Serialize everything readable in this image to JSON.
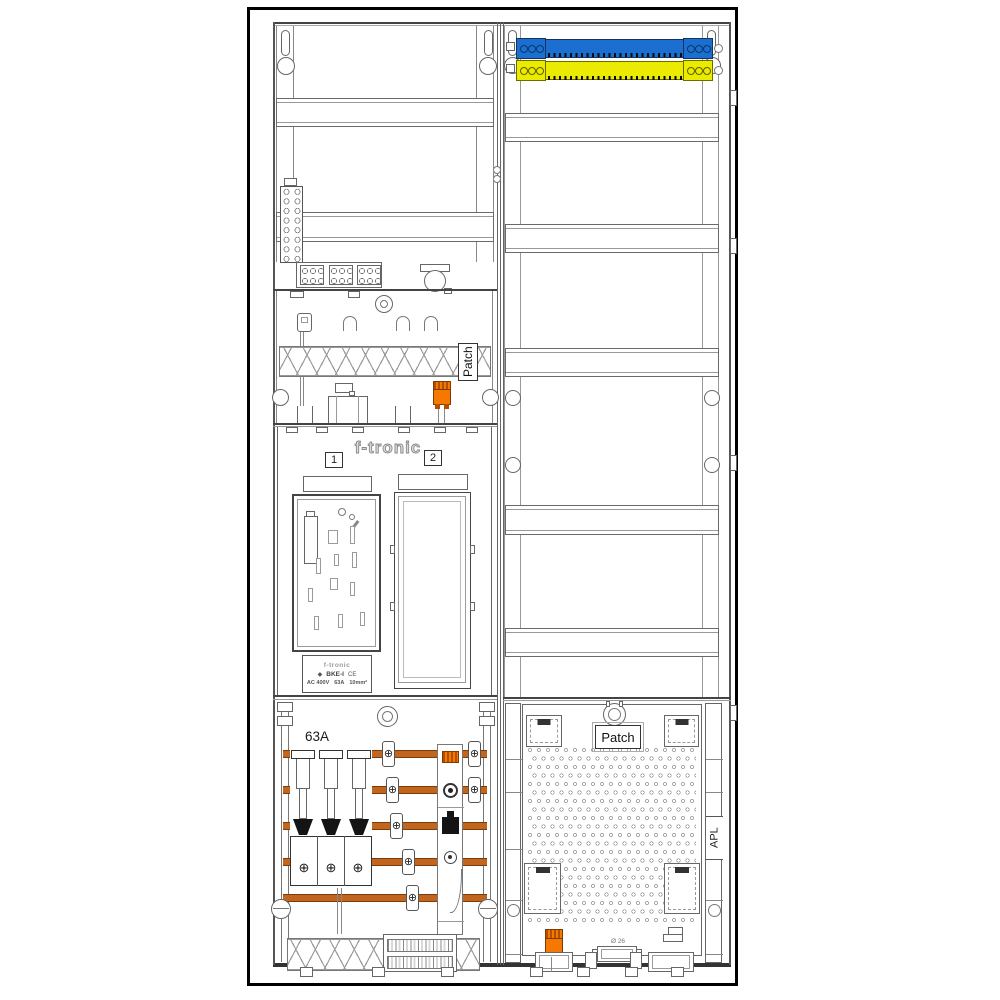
{
  "colors": {
    "page_frame": "#000000",
    "line": "#555555",
    "busbar_orange": "#c2661f",
    "connector_orange": "#f57900",
    "neutral_rail_blue": "#1b6fd0",
    "pe_rail_yellow": "#ebeb00",
    "black_part": "#141414"
  },
  "icons": {
    "clamp_screw": "⊕",
    "brand_logo_glyph": "◆"
  },
  "left_column": {
    "brand_logo": "f-tronic",
    "meter_fields": [
      {
        "label": "1"
      },
      {
        "label": "2"
      }
    ],
    "patch_label": "Patch",
    "busbar_rating": "63A",
    "meter_type_plate": {
      "brand": "f-tronic",
      "type": "BKE-I",
      "ce_mark": "CE",
      "voltage": "AC 400V",
      "current": "63A",
      "cross_section": "10mm²"
    }
  },
  "right_column": {
    "patch_label": "Patch",
    "apl_label": "APL",
    "knockout_diameter": "Ø 26"
  }
}
